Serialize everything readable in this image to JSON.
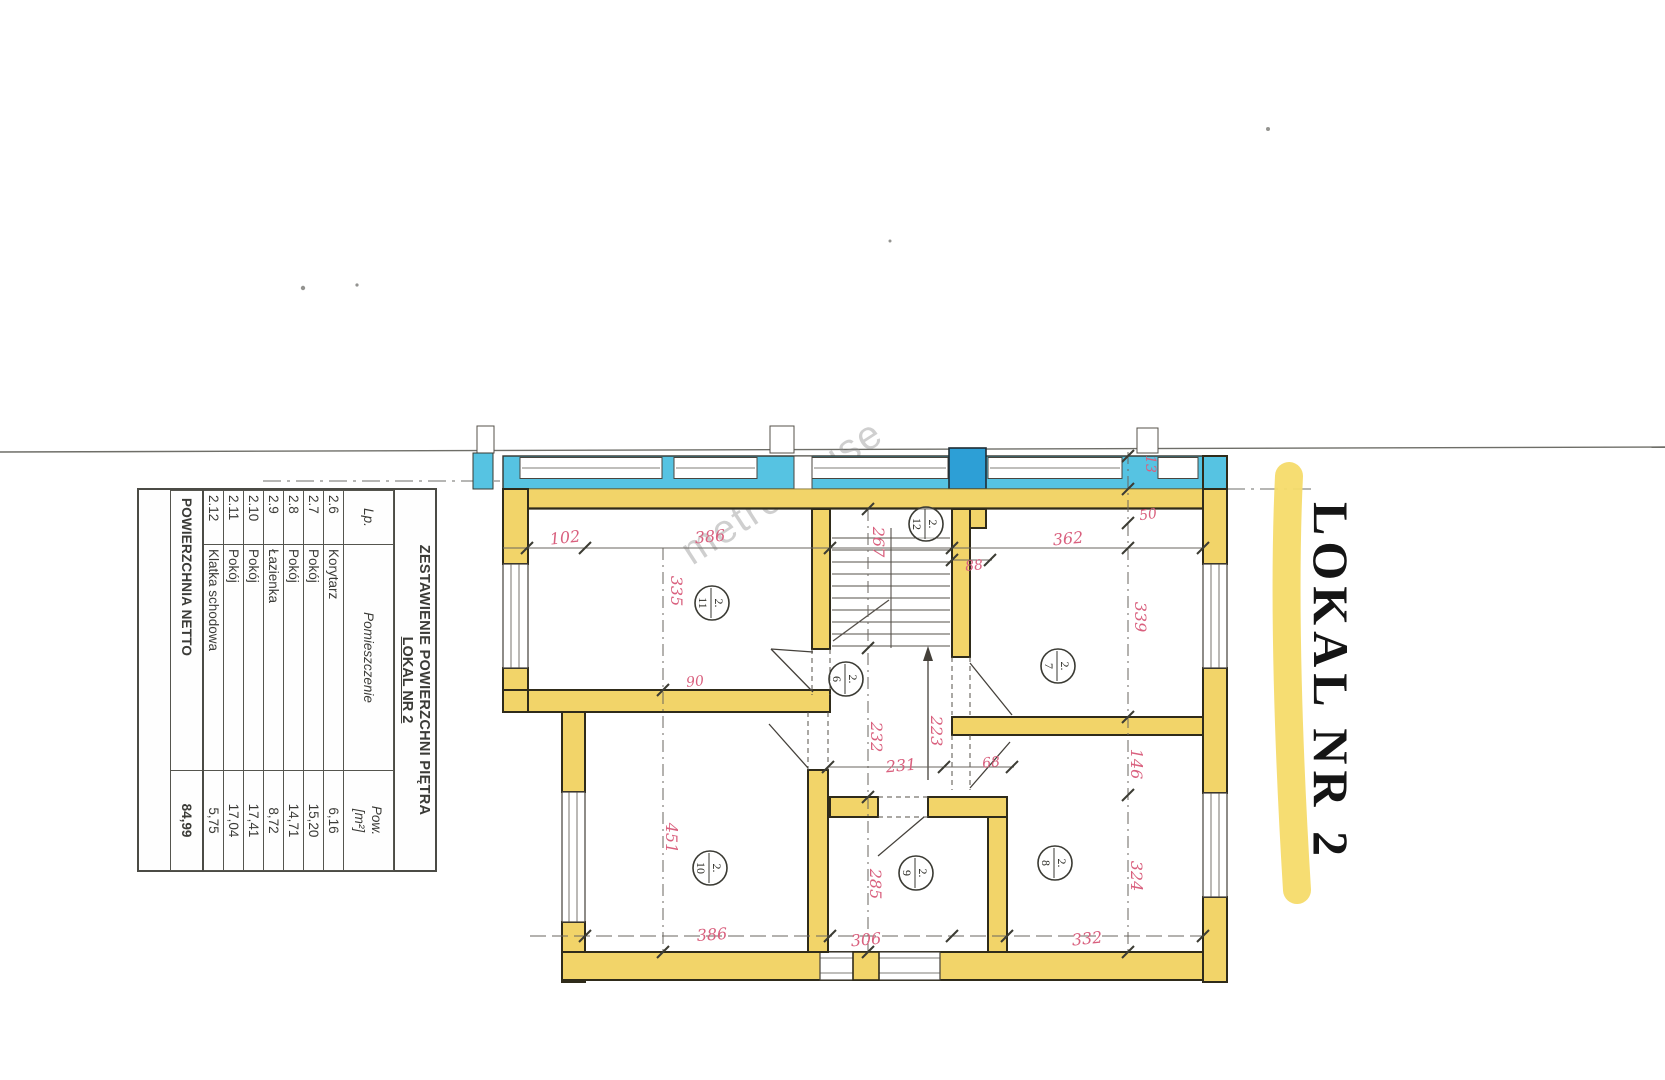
{
  "page": {
    "watermark": "metrohouse"
  },
  "side_label": {
    "text": "LOKAL NR 2"
  },
  "area_table": {
    "title": "ZESTAWIENIE POWIERZCHNI PIĘTRA",
    "subtitle": "LOKAL NR 2",
    "columns": {
      "lp": "Lp.",
      "room": "Pomieszczenie",
      "area_line1": "Pow.",
      "area_line2": "[m²]"
    },
    "rows": [
      {
        "lp": "2.6",
        "room": "Korytarz",
        "area": "6,16"
      },
      {
        "lp": "2.7",
        "room": "Pokój",
        "area": "15,20"
      },
      {
        "lp": "2.8",
        "room": "Pokój",
        "area": "14,71"
      },
      {
        "lp": "2.9",
        "room": "Łazienka",
        "area": "8,72"
      },
      {
        "lp": "2.10",
        "room": "Pokój",
        "area": "17,41"
      },
      {
        "lp": "2.11",
        "room": "Pokój",
        "area": "17,04"
      },
      {
        "lp": "2.12",
        "room": "Klatka schodowa",
        "area": "5,75"
      }
    ],
    "footer": {
      "label": "POWIERZCHNIA NETTO",
      "value": "84,99"
    }
  },
  "floor_plan": {
    "room_markers": [
      "2.6",
      "2.7",
      "2.8",
      "2.9",
      "2.10",
      "2.11",
      "2.12"
    ],
    "dimensions": [
      "102",
      "386",
      "335",
      "267",
      "13",
      "50",
      "362",
      "88",
      "339",
      "90",
      "223",
      "232",
      "231",
      "68",
      "451",
      "285",
      "146",
      "324",
      "386",
      "306",
      "332"
    ],
    "colors": {
      "wall_highlight": "#F2D469",
      "neighbor_wall": "#56C3E2",
      "chimney": "#2D9FD6",
      "dimension_text": "#D9607E",
      "label_highlight": "#F6DB6A"
    }
  }
}
